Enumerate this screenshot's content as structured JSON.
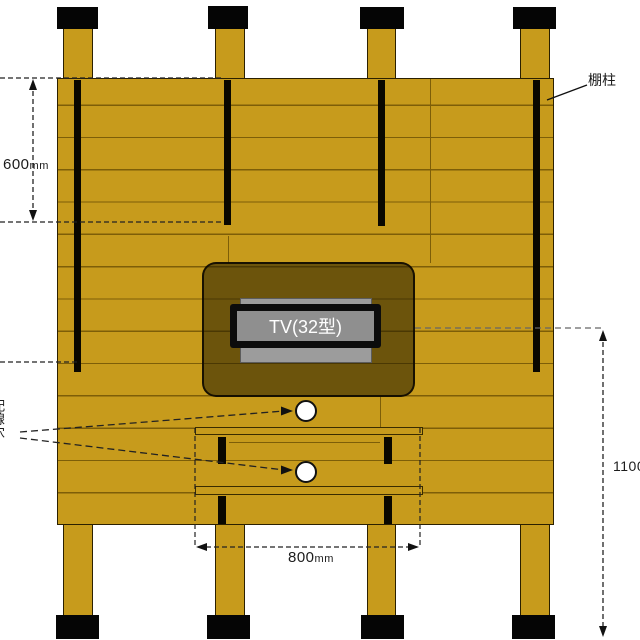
{
  "diagram": {
    "shelf_rail_label": "棚柱",
    "tv_label": "TV(32型)",
    "wiring_label_fragment": "配線穴",
    "dim_left": {
      "value": "600",
      "unit": "mm"
    },
    "dim_bottom": {
      "value": "800",
      "unit": "mm"
    },
    "dim_right": {
      "value": "1100"
    },
    "colors": {
      "wood": "#c79b1c",
      "plank_line": "#7d5e08",
      "rail_black": "#0a0800",
      "tv_screen_gray": "#8f8f8f",
      "tv_back_gray": "#9c9c9c",
      "tv_zone_overlay": "rgba(33,25,0,0.55)"
    }
  }
}
